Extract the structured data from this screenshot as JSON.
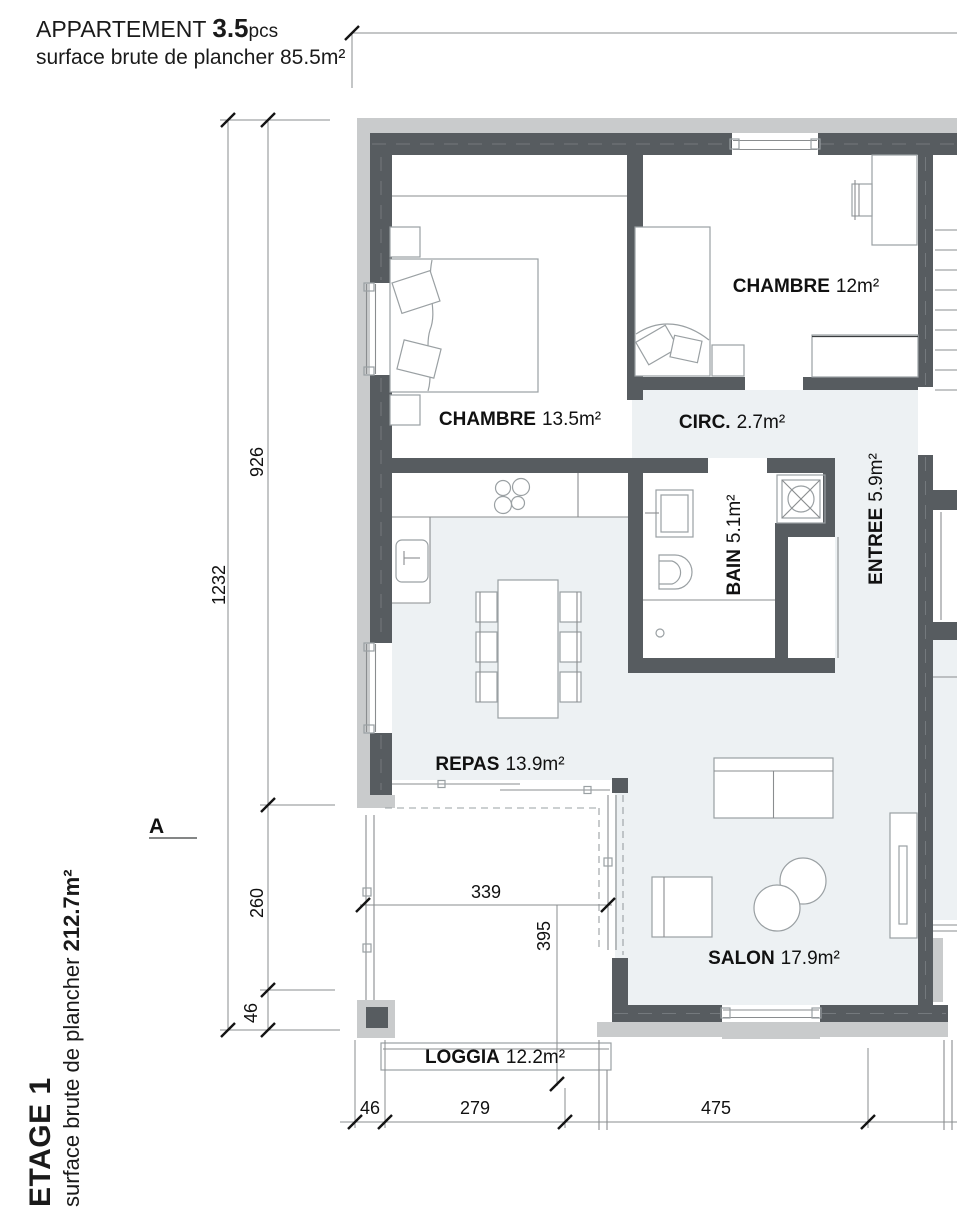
{
  "title_block": {
    "brand": "APPARTEMENT",
    "pieces": "3.5",
    "pieces_unit": "pcs",
    "surface_line": "surface brute de plancher 85.5m²"
  },
  "floor_block": {
    "floor_name": "ETAGE 1",
    "surface_prefix": "surface brute de plancher ",
    "surface_value": "212.7m²"
  },
  "rooms": {
    "chambre1": {
      "name": "CHAMBRE",
      "area": "13.5m²"
    },
    "chambre2": {
      "name": "CHAMBRE",
      "area": "12m²"
    },
    "circ": {
      "name": "CIRC.",
      "area": "2.7m²"
    },
    "bain": {
      "name": "BAIN",
      "area": "5.1m²"
    },
    "entree": {
      "name": "ENTREE",
      "area": "5.9m²"
    },
    "repas": {
      "name": "REPAS",
      "area": "13.9m²"
    },
    "salon": {
      "name": "SALON",
      "area": "17.9m²"
    },
    "loggia": {
      "name": "LOGGIA",
      "area": "12.2m²"
    }
  },
  "dimensions": {
    "left_total": "1232",
    "left_top": "926",
    "left_mid": "260",
    "left_bottom": "46",
    "bottom_left": "46",
    "bottom_mid": "279",
    "bottom_right": "475",
    "loggia_width": "339",
    "loggia_depth": "395"
  },
  "section_marker": {
    "label": "A"
  },
  "colors": {
    "wall": "#575c60",
    "wall_outer": "#c9cbcc",
    "floor_tint": "#edf1f3",
    "drawing_line": "#8a8d8f",
    "text": "#1a1a1a"
  }
}
